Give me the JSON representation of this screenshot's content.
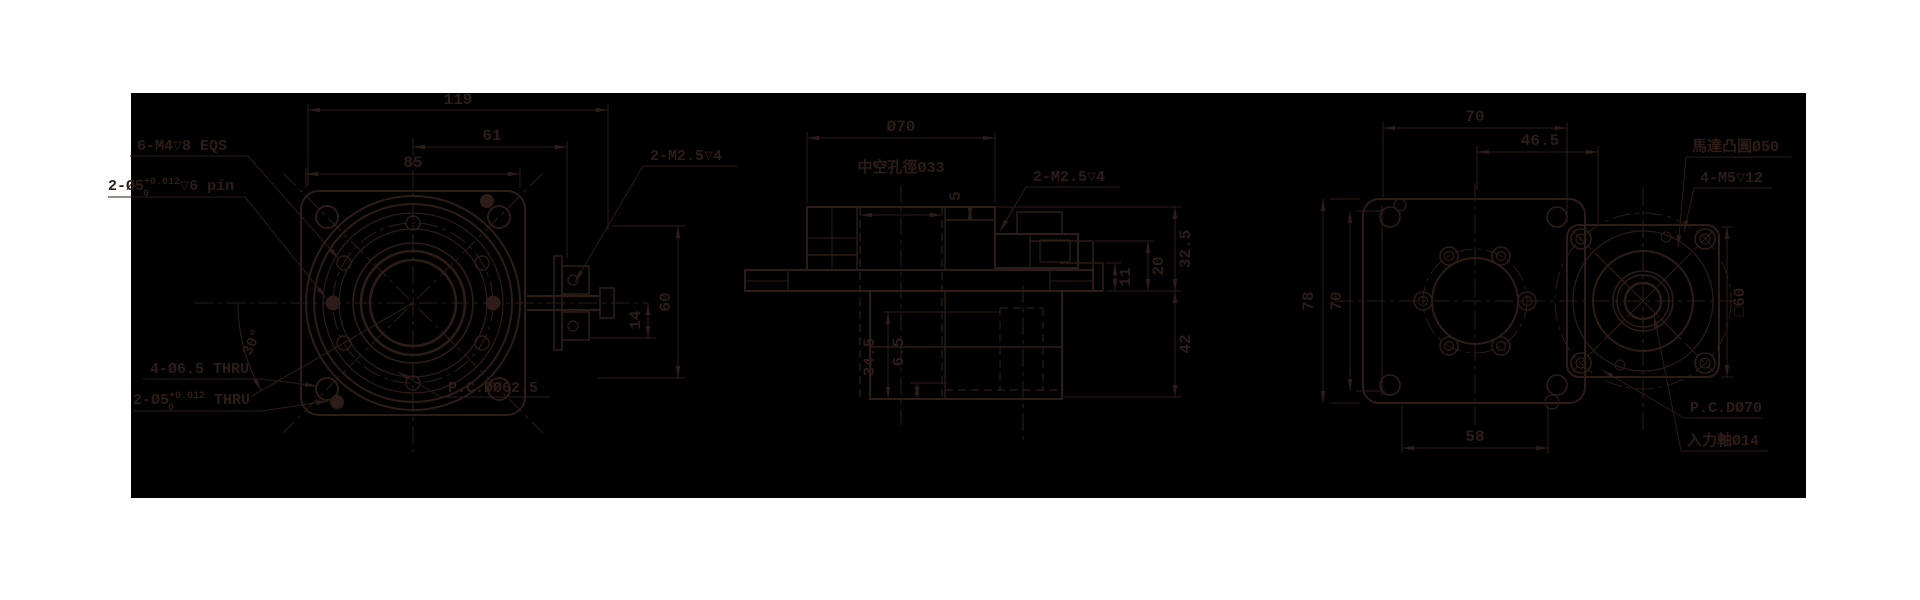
{
  "colors": {
    "ink": "#2d1c17",
    "background": "#000000",
    "page": "#ffffff"
  },
  "front": {
    "dims": {
      "d119": "119",
      "d61": "61",
      "d85": "85",
      "d14": "14",
      "d60": "60",
      "angle30": "30°"
    },
    "labels": {
      "screws": "6-M4▽8 EQS",
      "pin_base": "2-Ø5",
      "pin_sup": "+0.012",
      "pin_sub": "0",
      "pin_rest": "▽6 pin",
      "tab_screws": "2-M2.5▽4",
      "corner_holes": "4-Ø6.5 THRU",
      "pin2_base": "2-Ø5",
      "pin2_sup": "+0.012",
      "pin2_sub": "0",
      "pin2_rest": " THRU",
      "pcd": "P.C.DØ62.5"
    }
  },
  "section": {
    "dims": {
      "dia70": "Ø70",
      "d5": "5",
      "d32_5": "32.5",
      "d20": "20",
      "d11": "11",
      "d42": "42",
      "d34_5": "34.5",
      "d6_5": "6.5"
    },
    "labels": {
      "hollow_bore": "中空孔徑Ø33",
      "screws": "2-M2.5▽4"
    }
  },
  "rear": {
    "dims": {
      "d70_top": "70",
      "d46_5": "46.5",
      "d78": "78",
      "d70_left": "70",
      "d58": "58",
      "sq60": "□60"
    },
    "labels": {
      "motor_boss": "馬達凸圓Ø50",
      "screws": "4-M5▽12",
      "pcd": "P.C.DØ70",
      "input_shaft": "入力軸Ø14"
    }
  }
}
